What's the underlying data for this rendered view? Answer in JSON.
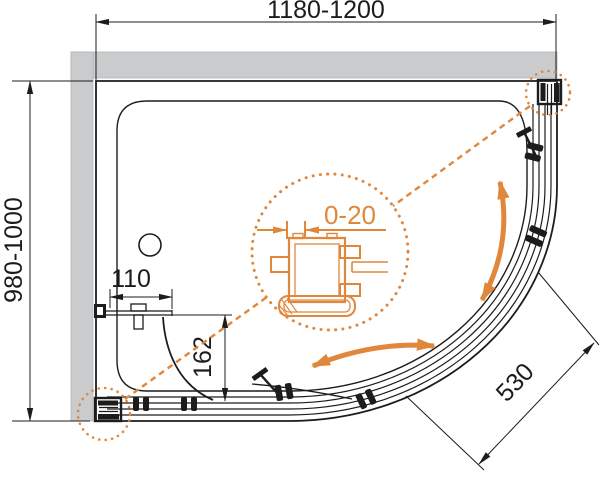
{
  "page": {
    "background": "#FFFFFF"
  },
  "drawing": {
    "kind": "shower-enclosure-top-view-plan",
    "dimensions": {
      "overall_width": "1180-1200",
      "overall_depth": "980-1000",
      "side_bar_length": "110",
      "fixed_panel_offset": "162",
      "door_opening": "530",
      "profile_adjustment": "0-20"
    },
    "colors": {
      "accent_orange": "#E0873C",
      "wall_gray": "#C9CBCD",
      "line_black": "#1C1C1C"
    }
  }
}
